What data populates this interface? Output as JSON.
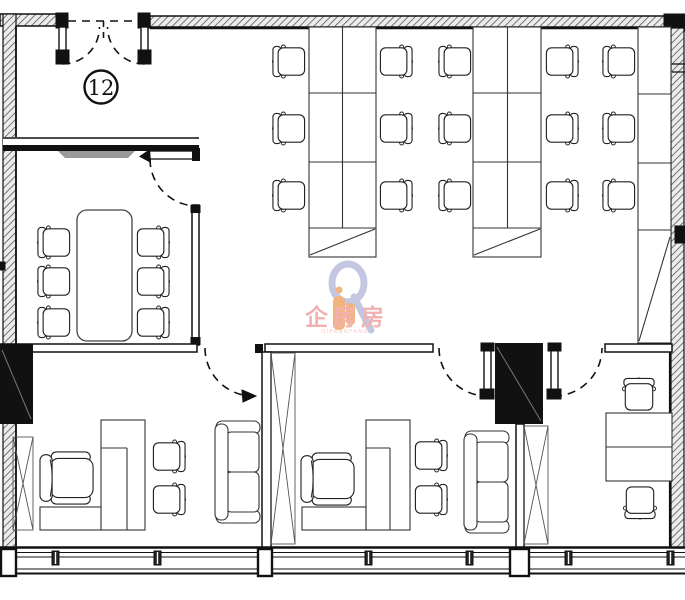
{
  "plan": {
    "unit_label": "12",
    "background": "#ffffff",
    "line_color": "#1a1a1a"
  },
  "watermark": {
    "title": "企房房",
    "subtitle": "QIFANGFANG",
    "title_color": "#ef9e9d",
    "subtitle_color": "#f2bbba",
    "logo_ring_color": "#b5badb",
    "logo_hand_color": "#f0a25f"
  }
}
